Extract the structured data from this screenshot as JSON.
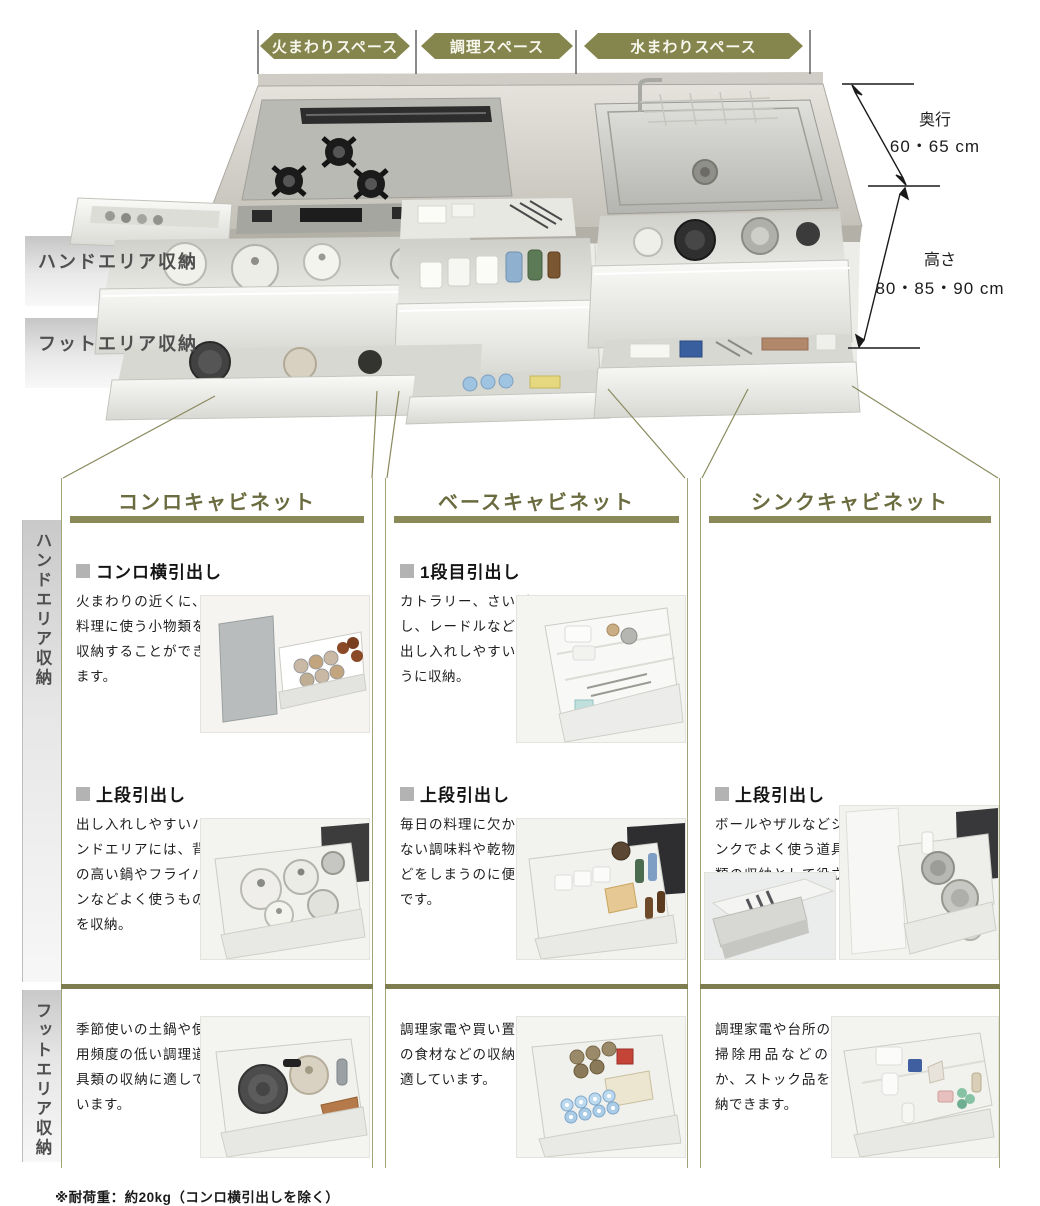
{
  "top_spaces": {
    "fire": "火まわりスペース",
    "cook": "調理スペース",
    "water": "水まわりスペース"
  },
  "dimensions": {
    "depth_label": "奥行",
    "depth_value": "60・65 cm",
    "height_label": "高さ",
    "height_value": "80・85・90 cm"
  },
  "area_bands": {
    "hand": "ハンドエリア収納",
    "foot": "フットエリア収納"
  },
  "side_rails": {
    "hand": "ハンドエリア収納",
    "foot": "フットエリア収納"
  },
  "columns": [
    {
      "title": "コンロキャビネット",
      "hand_sections": [
        {
          "heading": "コンロ横引出し",
          "body": "火まわりの近くに、料理に使う小物類を収納することができます。"
        },
        {
          "heading": "上段引出し",
          "body": "出し入れしやすいハンドエリアには、背の高い鍋やフライパンなどよく使うものを収納。"
        }
      ],
      "foot_section": {
        "body": "季節使いの土鍋や使用頻度の低い調理道具類の収納に適しています。"
      }
    },
    {
      "title": "ベースキャビネット",
      "hand_sections": [
        {
          "heading": "1段目引出し",
          "body": "カトラリー、さいばし、レードルなどを出し入れしやすいように収納。"
        },
        {
          "heading": "上段引出し",
          "body": "毎日の料理に欠かせない調味料や乾物などをしまうのに便利です。"
        }
      ],
      "foot_section": {
        "body": "調理家電や買い置きの食材などの収納に適しています。"
      }
    },
    {
      "title": "シンクキャビネット",
      "hand_sections": [
        {
          "heading": "上段引出し",
          "body": "ボールやザルなどシンクでよく使う道具類の収納として役立ちます。"
        }
      ],
      "foot_section": {
        "body": "調理家電や台所のお掃除用品などのほか、ストック品を収納できます。"
      }
    }
  ],
  "footnote": "※耐荷重：約20kg（コンロ横引出しを除く）",
  "colors": {
    "accent_olive": "#85854e",
    "title_olive": "#6b6b40",
    "bar_olive": "#8a8a58",
    "border_olive": "#a3a379"
  }
}
